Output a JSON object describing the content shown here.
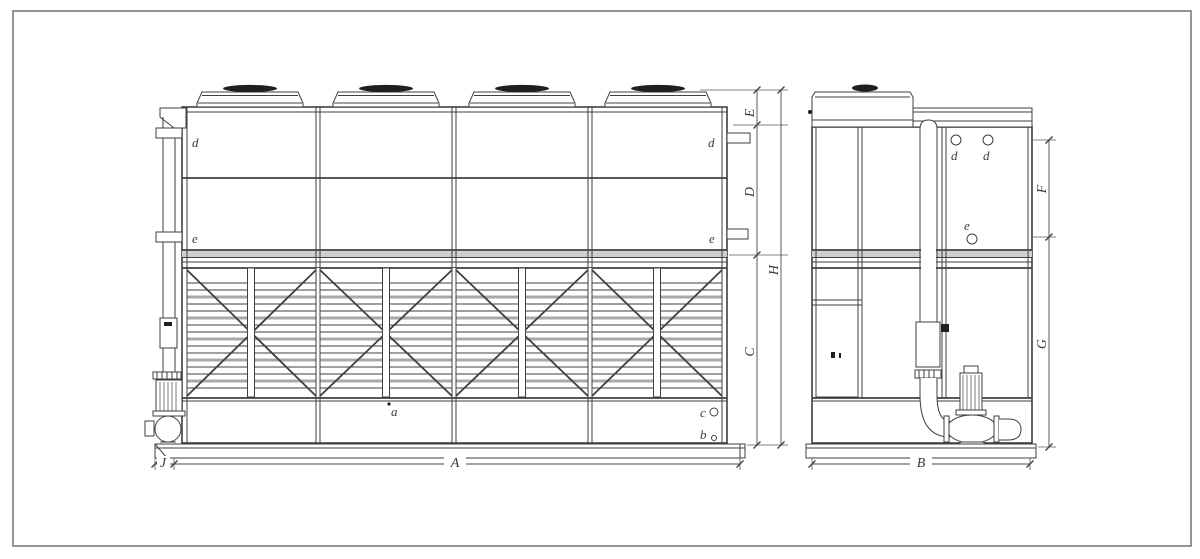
{
  "drawing": {
    "description": "Two-view dimensioned engineering drawing of a closed-circuit cooling tower: front elevation with four fan cowls, louvered air-inlet section, basin and spray pump; side elevation with riser pipe, access door and pump",
    "dim_labels": {
      "A": "A",
      "B": "B",
      "C": "C",
      "D": "D",
      "E": "E",
      "F": "F",
      "G": "G",
      "H": "H",
      "J": "J"
    },
    "connection_labels": {
      "a": "a",
      "b": "b",
      "c": "c",
      "d": "d",
      "e": "e"
    },
    "colors": {
      "line": "#3f3f3f",
      "thin_line": "#5a5a5a",
      "louver_gray": "#a8a8a8",
      "fan_cap": "#1f1f1f",
      "background": "#ffffff"
    }
  }
}
